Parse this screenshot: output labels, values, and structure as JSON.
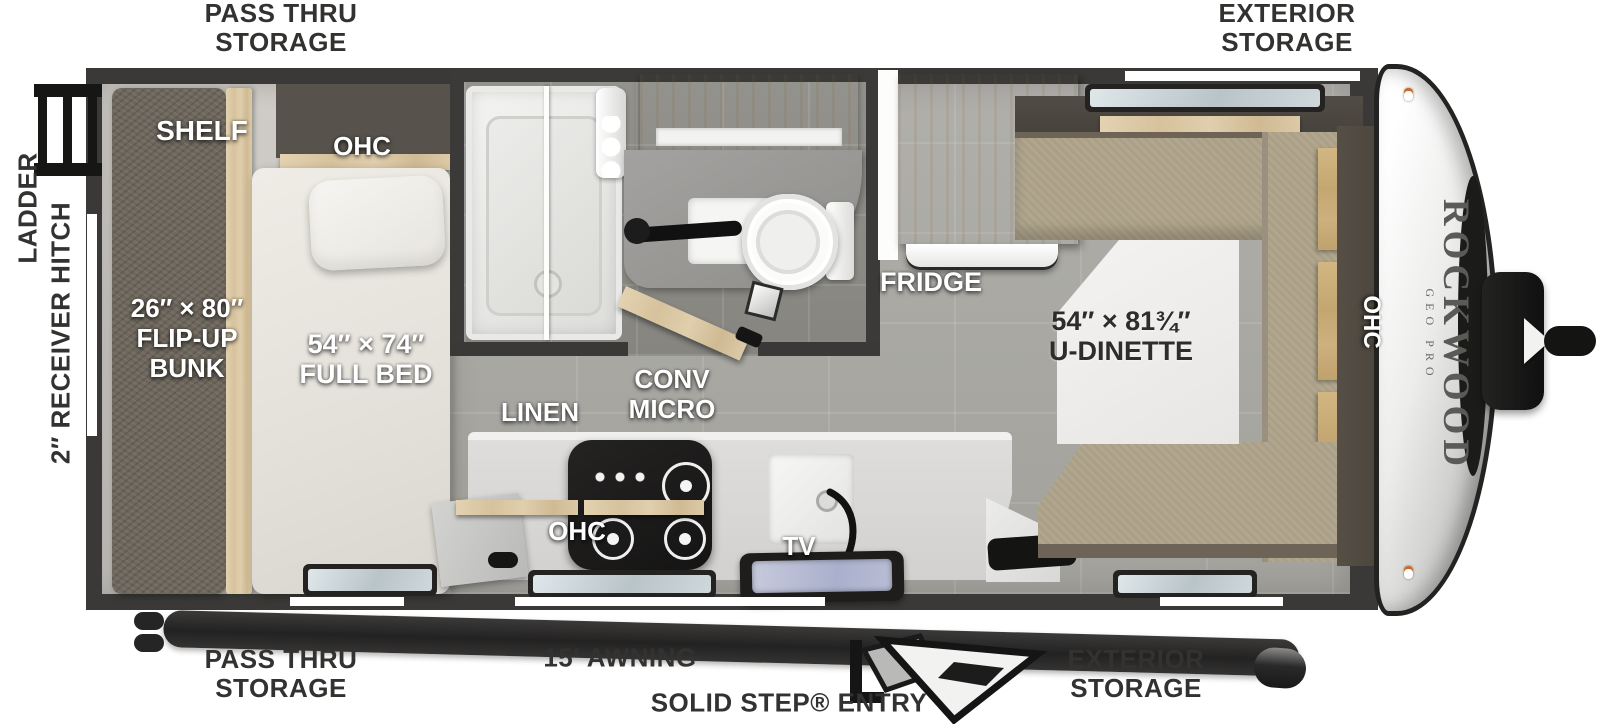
{
  "plan": {
    "brand": {
      "name": "ROCKWOOD",
      "sub": "GEO PRO"
    },
    "exterior_labels": {
      "pass_thru_storage_top": [
        "PASS THRU",
        "STORAGE"
      ],
      "exterior_storage_top": [
        "EXTERIOR",
        "STORAGE"
      ],
      "ladder": "LADDER",
      "receiver_hitch": "2″ RECEIVER HITCH",
      "pass_thru_storage_bottom": [
        "PASS THRU",
        "STORAGE"
      ],
      "awning": "15′ AWNING",
      "entry": "SOLID STEP® ENTRY",
      "exterior_storage_bottom": [
        "EXTERIOR",
        "STORAGE"
      ]
    },
    "interior_labels": {
      "shelf": "SHELF",
      "bed_ohc": "OHC",
      "bunk": [
        "26″ × 80″",
        "FLIP-UP",
        "BUNK"
      ],
      "full_bed": [
        "54″ × 74″",
        "FULL BED"
      ],
      "linen": "LINEN",
      "conv_micro": [
        "CONV",
        "MICRO"
      ],
      "kitchen_ohc": "OHC",
      "tv": "TV",
      "fridge": "FRIDGE",
      "u_dinette": [
        "54″ × 81¾″",
        "U-DINETTE"
      ],
      "right_ohc": "OHC"
    },
    "colors": {
      "wall": "#3a3937",
      "label_dark": "#333230",
      "label_light": "#ffffff",
      "wood": "#d9c7a6",
      "bench": "#b2a78e",
      "floor_tile": "#a8a7a2"
    }
  }
}
